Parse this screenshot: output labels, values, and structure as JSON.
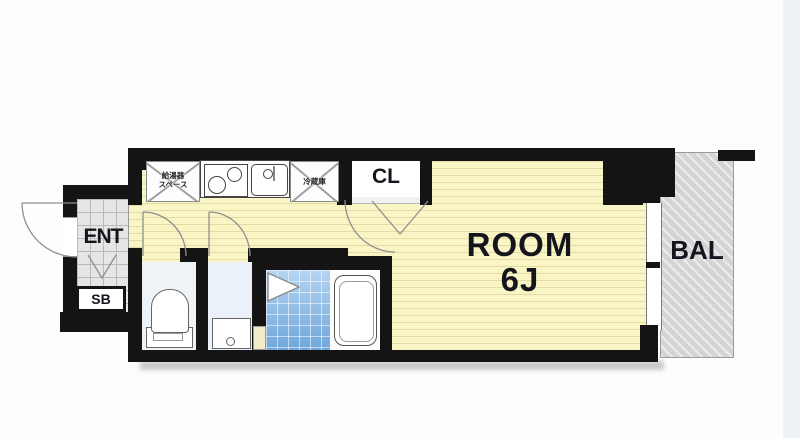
{
  "floorplan": {
    "room_label_line1": "ROOM",
    "room_label_line2": "6J",
    "closet_label": "CL",
    "balcony_label": "BAL",
    "entrance_label": "ENT",
    "shoebox_label": "SB",
    "water_heater_line1": "給湯器",
    "water_heater_line2": "スペース",
    "refrigerator_label": "冷蔵庫",
    "colors": {
      "wall": "#141414",
      "room_floor": "#f9f5c5",
      "balcony": "#d4d4d4",
      "bath_tile": "#6fa6da",
      "entrance_tile": "#e6e6e6",
      "wet_area_floor": "#edf3f8",
      "label_text": "#15151d"
    }
  }
}
